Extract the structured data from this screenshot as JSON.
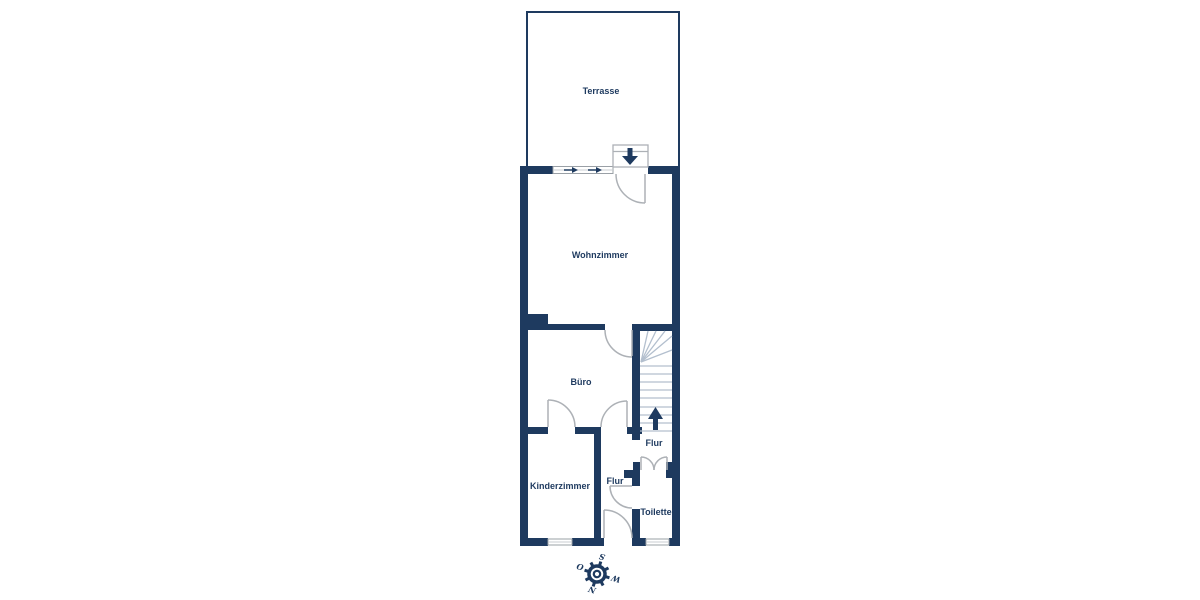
{
  "plan": {
    "rooms": {
      "terrasse": "Terrasse",
      "wohnzimmer": "Wohnzimmer",
      "buero": "Büro",
      "kinderzimmer": "Kinderzimmer",
      "flur_middle": "Flur",
      "flur_right": "Flur",
      "toilette": "Toilette"
    },
    "compass": {
      "top": "S",
      "left": "O",
      "right": "W",
      "bottom": "N"
    },
    "colors": {
      "wall": "#1e3a5f",
      "background": "#ffffff",
      "door_stroke": "#adb1b6",
      "stair_stroke": "#b3bfce",
      "window_stroke": "#9aa0a6",
      "arrow": "#1e3a5f"
    },
    "icons": {
      "entrance_arrow": "arrow-down-icon",
      "stairs_direction_arrow": "arrow-up-icon",
      "window_slide_arrows": "arrow-right-icon",
      "compass": "compass-rose-icon"
    }
  }
}
